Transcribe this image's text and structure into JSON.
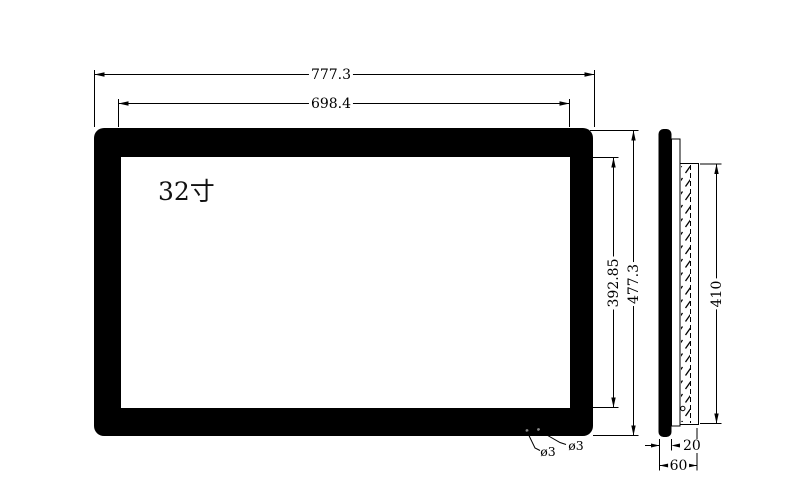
{
  "front_view": {
    "screen_label": "32寸",
    "outer_width": "777.3",
    "inner_width": "698.4",
    "outer_height": "477.3",
    "inner_height": "392.85",
    "hole_left_label": "ø3",
    "hole_right_label": "ø3"
  },
  "side_view": {
    "bracket_height": "410",
    "panel_thickness": "20",
    "total_depth": "60"
  },
  "colors": {
    "ink": "#000000",
    "paper": "#ffffff",
    "hole_dot": "#8a8a8a"
  }
}
